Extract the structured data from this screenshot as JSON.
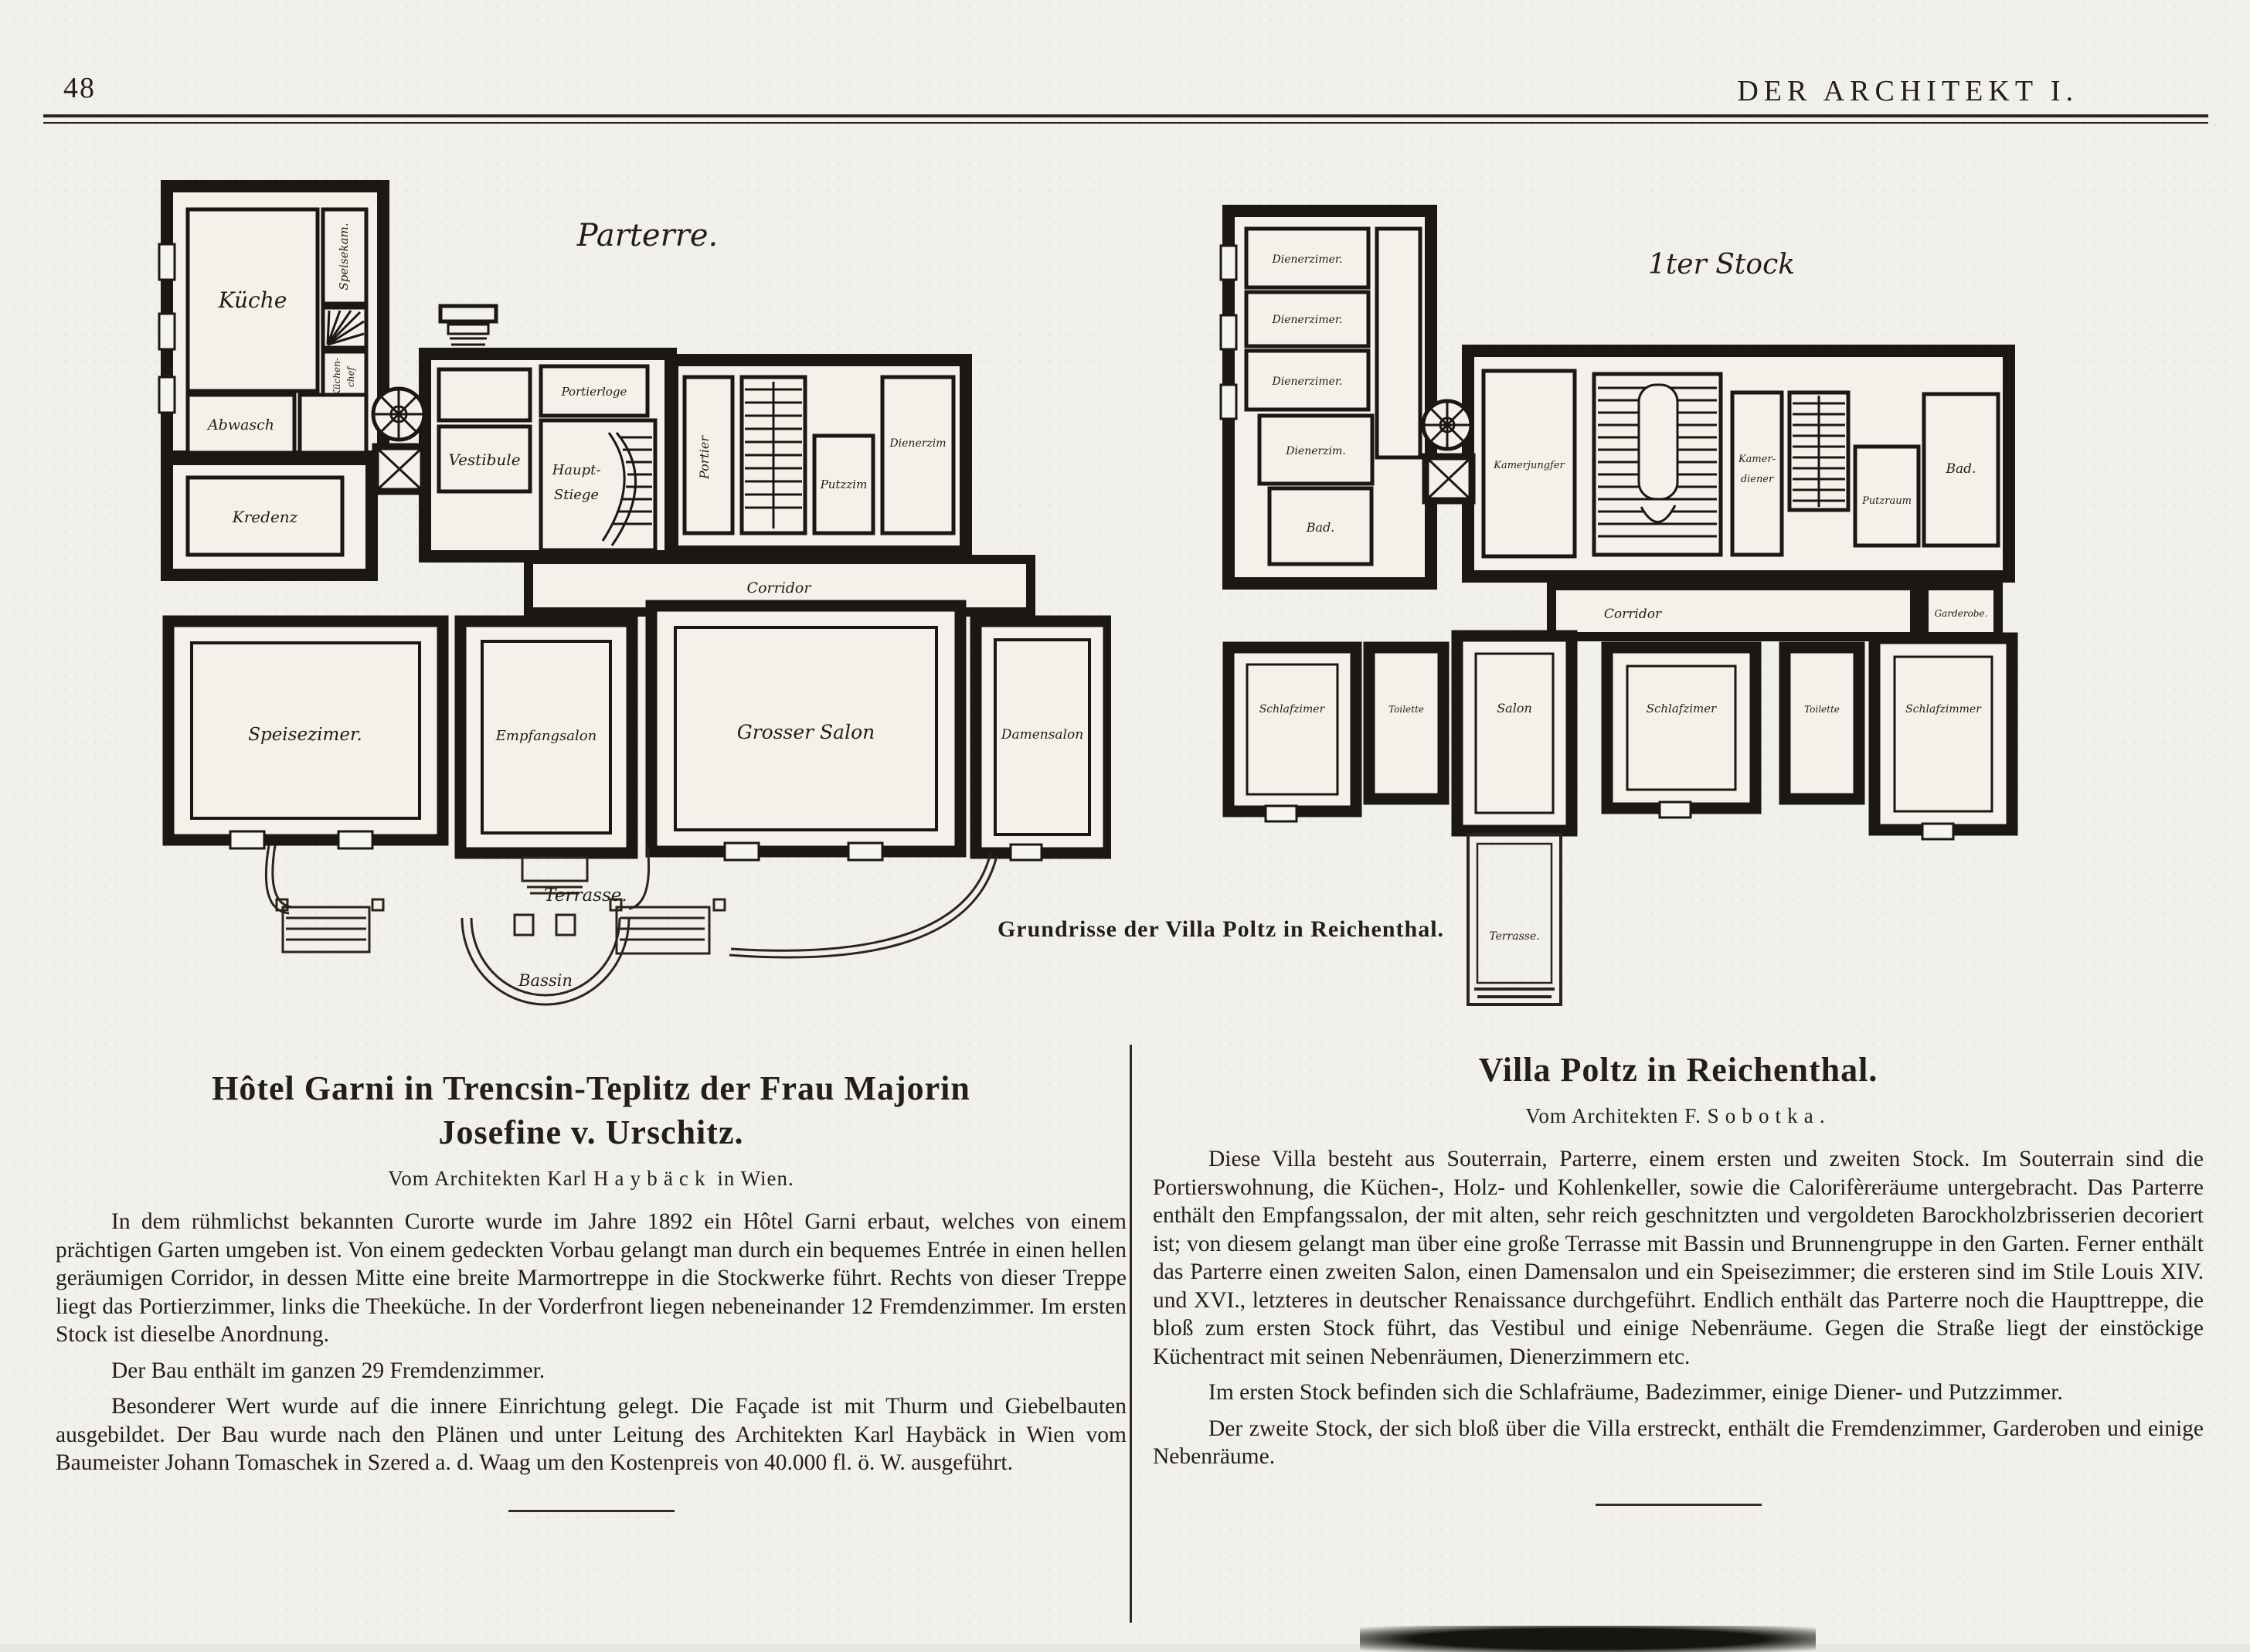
{
  "page": {
    "page_number": "48",
    "journal_title": "DER ARCHITEKT I.",
    "caption": "Grundrisse der Villa Poltz in Reichenthal."
  },
  "plans": {
    "parterre": {
      "title": "Parterre.",
      "rooms": {
        "kueche": "Küche",
        "speisekammer": "Speisekam.",
        "kuechenchef_line1": "Küchen-",
        "kuechenchef_line2": "chef",
        "abwasch": "Abwasch",
        "kredenz": "Kredenz",
        "vestibule": "Vestibule",
        "portierloge": "Portierloge",
        "hauptstiege_line1": "Haupt-",
        "hauptstiege_line2": "Stiege",
        "portier": "Portier",
        "putzzimmer": "Putzzim",
        "dienerzimmer": "Dienerzim",
        "corridor": "Corridor",
        "speisezimmer": "Speisezimer.",
        "empfangssalon": "Empfangsalon",
        "grosser_salon": "Grosser Salon",
        "damensalon": "Damensalon",
        "terrasse": "Terrasse.",
        "bassin": "Bassin"
      }
    },
    "erster_stock": {
      "title": "1ter Stock",
      "rooms": {
        "dienerzimmer_1": "Dienerzimer.",
        "dienerzimmer_2": "Dienerzimer.",
        "dienerzimmer_3": "Dienerzimer.",
        "dienerzimmer_4": "Dienerzim.",
        "bad_links": "Bad.",
        "kammerjungfer": "Kamerjungfer",
        "kammerdiener_line1": "Kamer-",
        "kammerdiener_line2": "diener",
        "putzraum": "Putzraum",
        "bad_rechts": "Bad.",
        "corridor": "Corridor",
        "garderobe": "Garderobe.",
        "schlafzimmer_1": "Schlafzimer",
        "toilette_1": "Toilette",
        "salon": "Salon",
        "schlafzimmer_2": "Schlafzimer",
        "toilette_2": "Toilette",
        "schlafzimmer_3": "Schlafzimmer",
        "terrasse": "Terrasse."
      }
    }
  },
  "articles": {
    "left": {
      "title_line1": "Hôtel Garni in Trencsin-Teplitz der Frau Majorin",
      "title_line2": "Josefine v. Urschitz.",
      "byline_pre": "Vom Architekten Karl",
      "byline_name": "Haybäck",
      "byline_post": "in Wien.",
      "paragraphs": [
        "In dem rühmlichst bekannten Curorte wurde im Jahre 1892 ein Hôtel Garni erbaut, welches von einem prächtigen Garten umgeben ist. Von einem gedeckten Vorbau gelangt man durch ein bequemes Entrée in einen hellen geräumigen Corridor, in dessen Mitte eine breite Marmortreppe in die Stockwerke führt. Rechts von dieser Treppe liegt das Portierzimmer, links die Theeküche. In der Vorderfront liegen nebeneinander 12 Fremdenzimmer. Im ersten Stock ist dieselbe Anordnung.",
        "Der Bau enthält im ganzen 29 Fremdenzimmer.",
        "Besonderer Wert wurde auf die innere Einrichtung gelegt. Die Façade ist mit Thurm und Giebelbauten ausgebildet. Der Bau wurde nach den Plänen und unter Leitung des Architekten Karl Haybäck in Wien vom Baumeister Johann Tomaschek in Szered a. d. Waag um den Kostenpreis von 40.000 fl. ö. W. ausgeführt."
      ]
    },
    "right": {
      "title_line1": "Villa Poltz in Reichenthal.",
      "byline_pre": "Vom Architekten F.",
      "byline_name": "Sobotka.",
      "byline_post": "",
      "paragraphs": [
        "Diese Villa besteht aus Souterrain, Parterre, einem ersten und zweiten Stock. Im Souterrain sind die Portierswohnung, die Küchen-, Holz- und Kohlenkeller, sowie die Calorifèreräume untergebracht. Das Parterre enthält den Empfangssalon, der mit alten, sehr reich geschnitzten und vergoldeten Barockholzbrisserien decoriert ist; von diesem gelangt man über eine große Terrasse mit Bassin und Brunnengruppe in den Garten. Ferner enthält das Parterre einen zweiten Salon, einen Damensalon und ein Speisezimmer; die ersteren sind im Stile Louis XIV. und XVI., letzteres in deutscher Renaissance durchgeführt. Endlich enthält das Parterre noch die Haupttreppe, die bloß zum ersten Stock führt, das Vestibul und einige Nebenräume. Gegen die Straße liegt der einstöckige Küchentract mit seinen Nebenräumen, Dienerzimmern etc.",
        "Im ersten Stock befinden sich die Schlafräume, Badezimmer, einige Diener- und Putzzimmer.",
        "Der zweite Stock, der sich bloß über die Villa erstreckt, enthält die Fremdenzimmer, Garderoben und einige Nebenräume."
      ]
    }
  }
}
